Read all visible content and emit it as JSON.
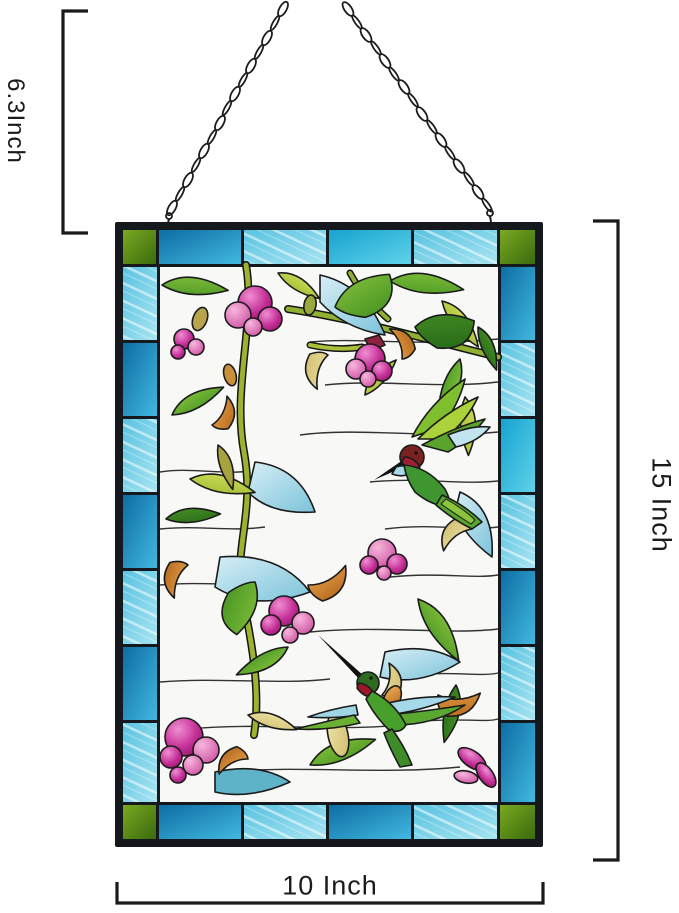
{
  "annotations": {
    "chain_height": {
      "label": "6.3Inch",
      "side": "left"
    },
    "panel_height": {
      "label": "15 Inch",
      "side": "right"
    },
    "panel_width": {
      "label": "10 Inch",
      "side": "bottom"
    },
    "line_color": "#1a1a1a"
  },
  "product": {
    "type": "stained glass hanging window panel",
    "motif": "two hummingbirds with fuchsia flowers and leaves",
    "hanger": "black metal jack chain",
    "palette": {
      "border_blue": "#1b86bc",
      "border_turquoise": "#6fcce6",
      "corner_green": "#55891a",
      "flower_magenta": "#c42e96",
      "leaf_green": "#5fa22a",
      "leaf_light_blue": "#a6d9e9",
      "sepal_orange": "#cc7f2e",
      "bird_throat_red": "#9c1f30",
      "frame_black": "#15181d",
      "clear_glass": "#f8f8f6"
    }
  }
}
